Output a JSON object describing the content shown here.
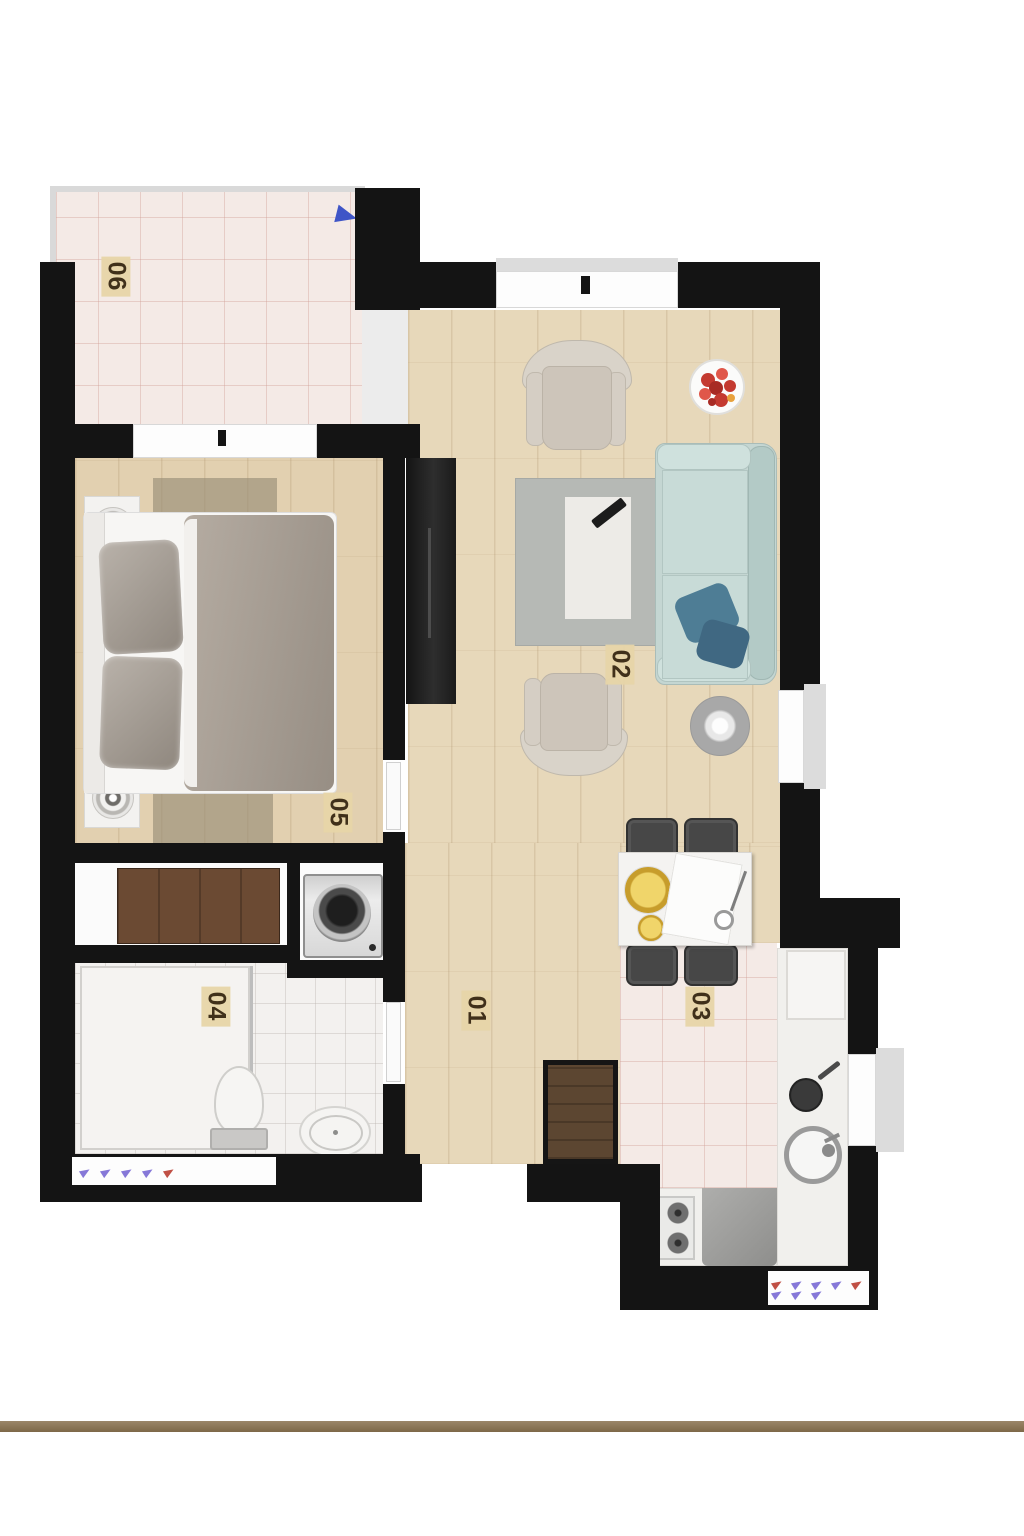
{
  "rooms": [
    {
      "label": "01"
    },
    {
      "label": "02"
    },
    {
      "label": "03"
    },
    {
      "label": "04"
    },
    {
      "label": "05"
    },
    {
      "label": "06"
    }
  ],
  "palette": {
    "wall": "#141414",
    "wood_floor": "#e7d8ba",
    "tile_pink": "#f4eae6",
    "tile_white": "#f3f1ef",
    "sofa_blue": "#c4d6d2",
    "pillow_blue": "#4e7d95",
    "label_bg": "#e7d5a8",
    "label_text": "#40301a",
    "north_arrow_blue": "#3f55c7",
    "radiator_purple": "#8678d8",
    "radiator_red": "#c05045",
    "baseline_brown": "#8c7557"
  }
}
